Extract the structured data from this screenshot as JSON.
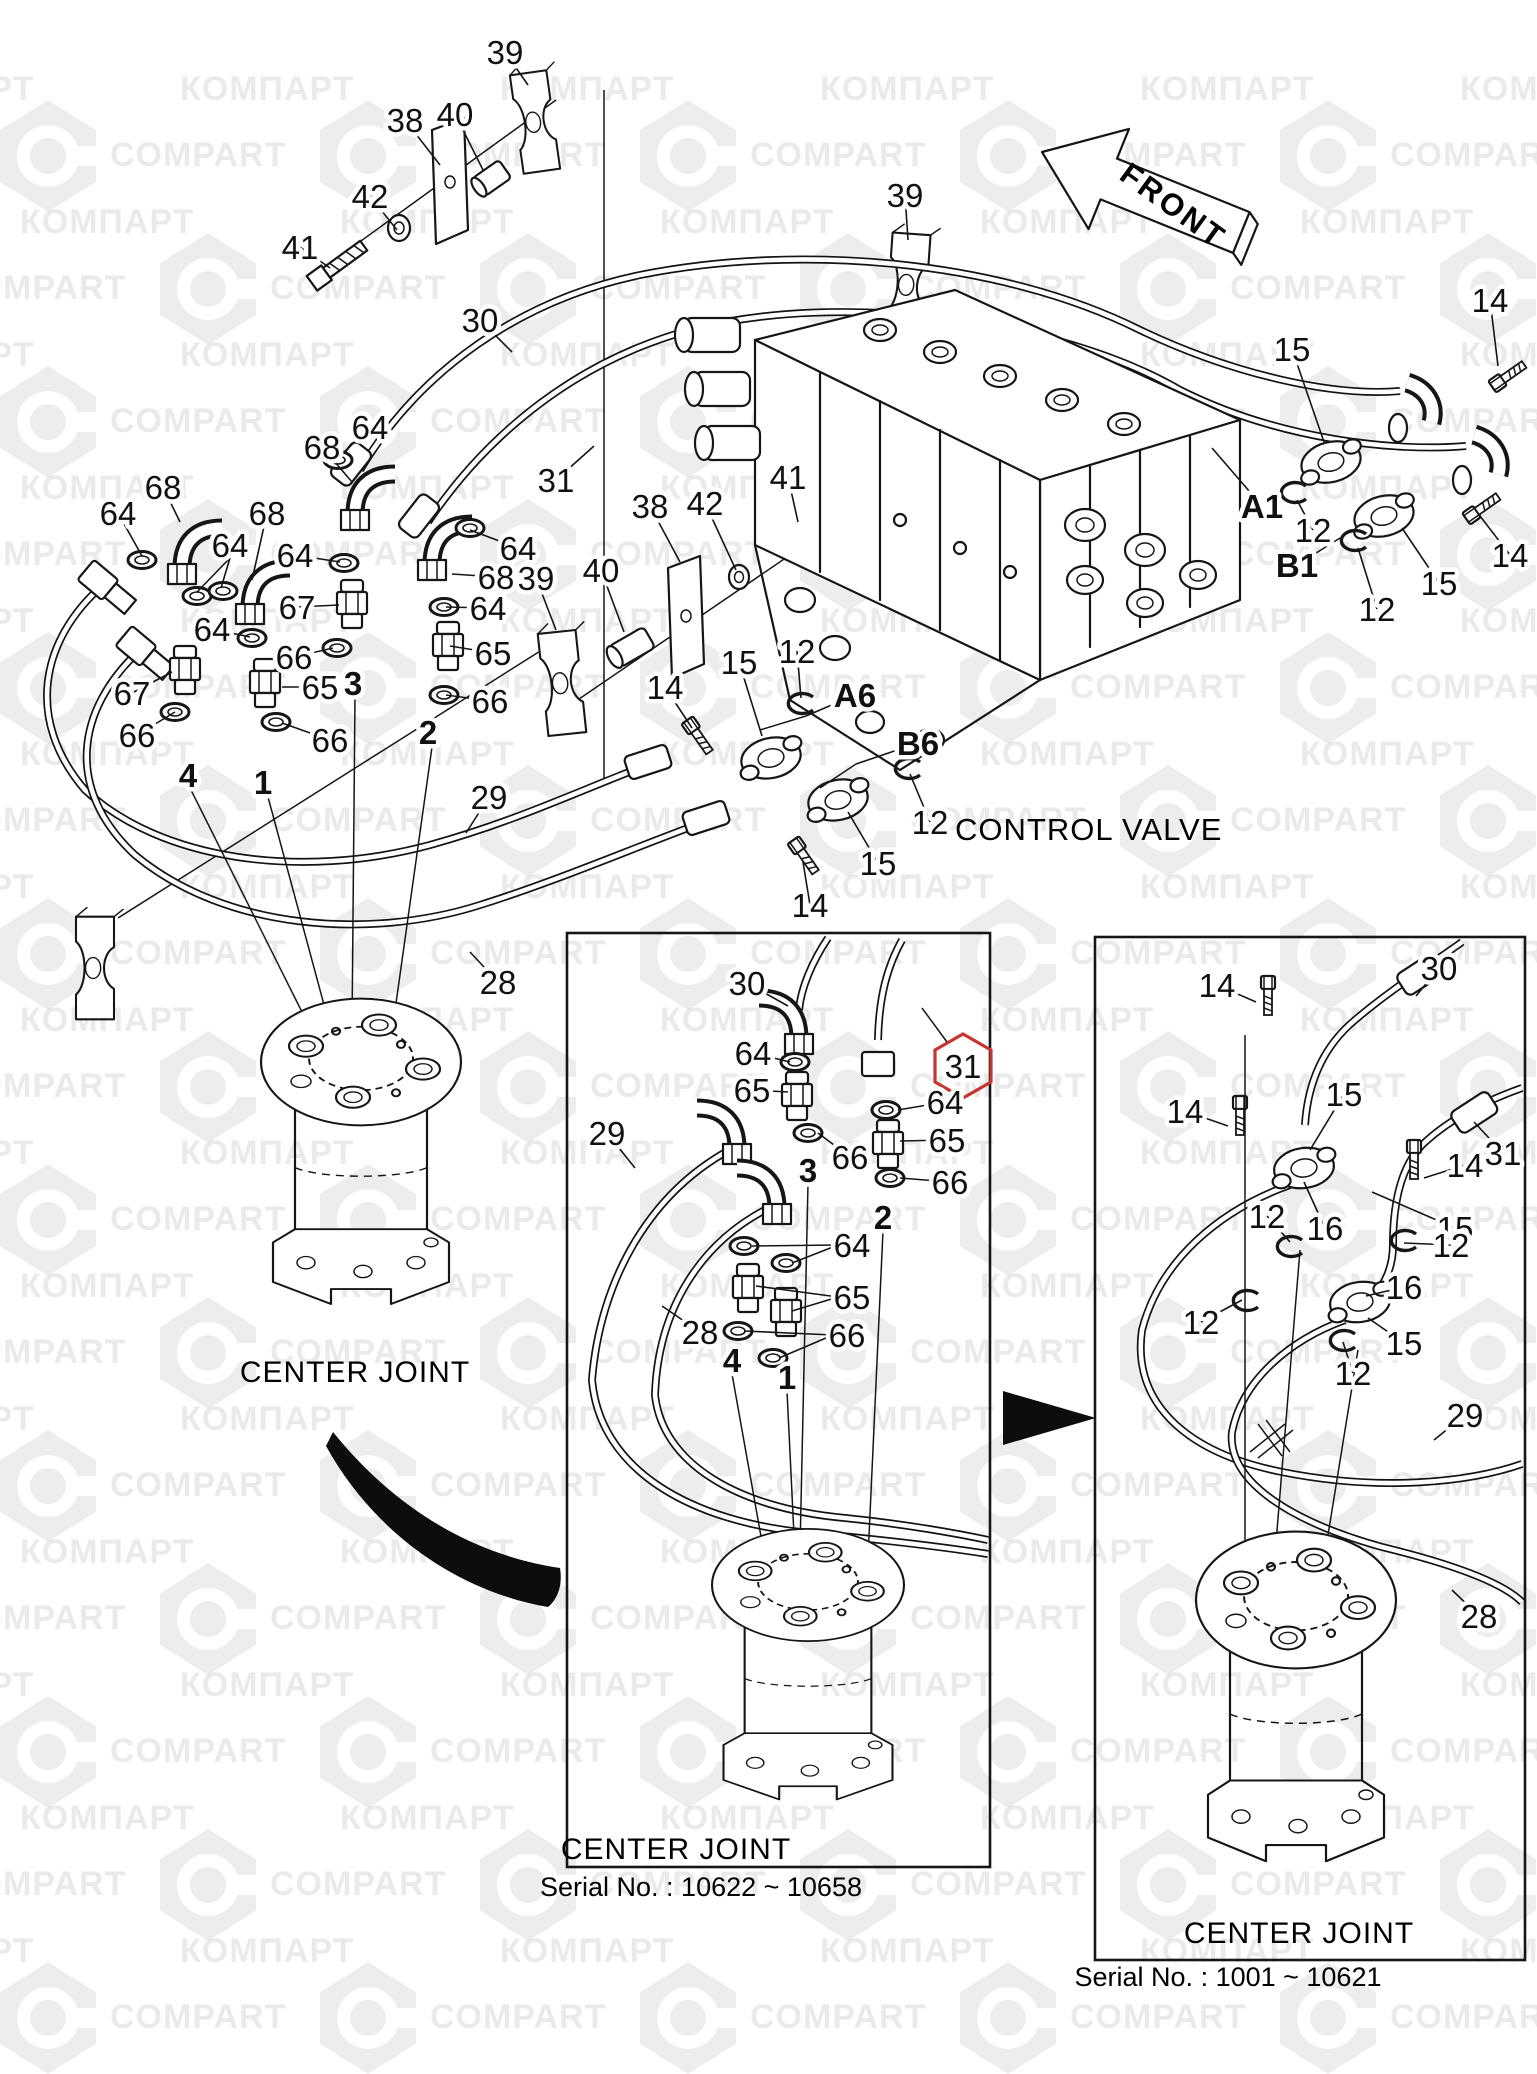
{
  "watermark": {
    "text_a": "КОМПАРТ",
    "text_b": "COMPART"
  },
  "front_label": "FRONT",
  "titles": {
    "control_valve": "CONTROL VALVE",
    "center_joint_main": "CENTER JOINT",
    "center_joint_mid": "CENTER JOINT",
    "center_joint_right": "CENTER JOINT",
    "serial_mid": "Serial No. : 10622 ~ 10658",
    "serial_right": "Serial No. : 1001 ~ 10621"
  },
  "highlight": {
    "part": "31",
    "color": "#c9342e"
  },
  "labels": [
    {
      "t": "41",
      "x": 300,
      "y": 247,
      "lx": 330,
      "ly": 268
    },
    {
      "t": "42",
      "x": 370,
      "y": 196,
      "lx": 397,
      "ly": 230
    },
    {
      "t": "38",
      "x": 405,
      "y": 120,
      "lx": 440,
      "ly": 165
    },
    {
      "t": "40",
      "x": 455,
      "y": 114,
      "lx": 483,
      "ly": 170
    },
    {
      "t": "39",
      "x": 505,
      "y": 52,
      "lx": 528,
      "ly": 85
    },
    {
      "t": "30",
      "x": 480,
      "y": 320,
      "lx": 512,
      "ly": 352
    },
    {
      "t": "31",
      "x": 556,
      "y": 480,
      "lx": 594,
      "ly": 446
    },
    {
      "t": "39",
      "x": 905,
      "y": 195,
      "lx": 908,
      "ly": 240
    },
    {
      "t": "64",
      "x": 370,
      "y": 427,
      "lx": 338,
      "ly": 458
    },
    {
      "t": "68",
      "x": 322,
      "y": 447,
      "lx": 352,
      "ly": 482
    },
    {
      "t": "68",
      "x": 163,
      "y": 487,
      "lx": 180,
      "ly": 522
    },
    {
      "t": "64",
      "x": 118,
      "y": 513,
      "lx": 142,
      "ly": 556
    },
    {
      "t": "68",
      "x": 267,
      "y": 513,
      "lx": 252,
      "ly": 580
    },
    {
      "t": "64",
      "x": 230,
      "y": 545,
      "leads": [
        [
          230,
          558,
          197,
          592
        ],
        [
          230,
          558,
          221,
          588
        ]
      ]
    },
    {
      "t": "64",
      "x": 295,
      "y": 555,
      "lx": 340,
      "ly": 562
    },
    {
      "t": "67",
      "x": 297,
      "y": 607,
      "lx": 339,
      "ly": 605
    },
    {
      "t": "64",
      "x": 212,
      "y": 629,
      "lx": 250,
      "ly": 637
    },
    {
      "t": "66",
      "x": 294,
      "y": 657,
      "lx": 333,
      "ly": 648
    },
    {
      "t": "65",
      "x": 320,
      "y": 687,
      "lx": 282,
      "ly": 687
    },
    {
      "t": "67",
      "x": 132,
      "y": 693,
      "lx": 172,
      "ly": 672
    },
    {
      "t": "66",
      "x": 137,
      "y": 735,
      "lx": 175,
      "ly": 712
    },
    {
      "t": "3",
      "x": 353,
      "y": 683,
      "b": 1
    },
    {
      "t": "4",
      "x": 188,
      "y": 775,
      "b": 1
    },
    {
      "t": "1",
      "x": 263,
      "y": 782,
      "b": 1
    },
    {
      "t": "2",
      "x": 428,
      "y": 732,
      "b": 1
    },
    {
      "t": "64",
      "x": 518,
      "y": 548,
      "lx": 470,
      "ly": 530
    },
    {
      "t": "68",
      "x": 496,
      "y": 577,
      "lx": 452,
      "ly": 574
    },
    {
      "t": "39",
      "x": 536,
      "y": 578,
      "lx": 556,
      "ly": 630
    },
    {
      "t": "64",
      "x": 488,
      "y": 608,
      "lx": 446,
      "ly": 607
    },
    {
      "t": "65",
      "x": 493,
      "y": 653,
      "lx": 450,
      "ly": 646
    },
    {
      "t": "66",
      "x": 490,
      "y": 701,
      "lx": 446,
      "ly": 695
    },
    {
      "t": "66",
      "x": 330,
      "y": 740,
      "lx": 282,
      "ly": 723
    },
    {
      "t": "40",
      "x": 601,
      "y": 570,
      "lx": 624,
      "ly": 632
    },
    {
      "t": "38",
      "x": 650,
      "y": 506,
      "lx": 680,
      "ly": 562
    },
    {
      "t": "42",
      "x": 705,
      "y": 503,
      "lx": 736,
      "ly": 570
    },
    {
      "t": "41",
      "x": 788,
      "y": 477,
      "lx": 798,
      "ly": 522
    },
    {
      "t": "14",
      "x": 665,
      "y": 687,
      "lx": 692,
      "ly": 728
    },
    {
      "t": "15",
      "x": 739,
      "y": 662,
      "lx": 762,
      "ly": 736
    },
    {
      "t": "12",
      "x": 797,
      "y": 651,
      "lx": 801,
      "ly": 698
    },
    {
      "t": "A6",
      "x": 855,
      "y": 695,
      "b": 1,
      "lx": 806,
      "ly": 716
    },
    {
      "t": "B6",
      "x": 918,
      "y": 743,
      "b": 1,
      "lx": 856,
      "ly": 764
    },
    {
      "t": "12",
      "x": 930,
      "y": 822,
      "lx": 910,
      "ly": 774
    },
    {
      "t": "15",
      "x": 878,
      "y": 863,
      "lx": 848,
      "ly": 812
    },
    {
      "t": "14",
      "x": 810,
      "y": 905,
      "lx": 803,
      "ly": 862
    },
    {
      "t": "29",
      "x": 489,
      "y": 797,
      "lx": 466,
      "ly": 833
    },
    {
      "t": "28",
      "x": 498,
      "y": 982,
      "lx": 470,
      "ly": 952
    },
    {
      "t": "15",
      "x": 1292,
      "y": 349,
      "lx": 1324,
      "ly": 442
    },
    {
      "t": "14",
      "x": 1490,
      "y": 300,
      "lx": 1498,
      "ly": 366
    },
    {
      "t": "A1",
      "x": 1262,
      "y": 506,
      "b": 1,
      "lx": 1212,
      "ly": 448
    },
    {
      "t": "12",
      "x": 1313,
      "y": 530,
      "lx": 1297,
      "ly": 500
    },
    {
      "t": "B1",
      "x": 1297,
      "y": 565,
      "b": 1,
      "lx": 1340,
      "ly": 538
    },
    {
      "t": "12",
      "x": 1377,
      "y": 609,
      "lx": 1358,
      "ly": 548
    },
    {
      "t": "15",
      "x": 1439,
      "y": 583,
      "lx": 1402,
      "ly": 528
    },
    {
      "t": "14",
      "x": 1510,
      "y": 555,
      "lx": 1480,
      "ly": 516
    },
    {
      "t": "30",
      "x": 747,
      "y": 983,
      "lx": 788,
      "ly": 1006
    },
    {
      "t": "64",
      "x": 753,
      "y": 1053,
      "lx": 790,
      "ly": 1062
    },
    {
      "t": "65",
      "x": 752,
      "y": 1090,
      "lx": 788,
      "ly": 1092
    },
    {
      "t": "66",
      "x": 850,
      "y": 1157,
      "lx": 818,
      "ly": 1133
    },
    {
      "t": "31",
      "x": 963,
      "y": 1066
    },
    {
      "t": "64",
      "x": 945,
      "y": 1102,
      "lx": 898,
      "ly": 1110
    },
    {
      "t": "65",
      "x": 947,
      "y": 1140,
      "lx": 900,
      "ly": 1141
    },
    {
      "t": "66",
      "x": 950,
      "y": 1182,
      "lx": 900,
      "ly": 1178
    },
    {
      "t": "29",
      "x": 607,
      "y": 1133,
      "lx": 635,
      "ly": 1168
    },
    {
      "t": "3",
      "x": 808,
      "y": 1170,
      "b": 1
    },
    {
      "t": "2",
      "x": 883,
      "y": 1217,
      "b": 1
    },
    {
      "t": "64",
      "x": 852,
      "y": 1245,
      "leads": [
        [
          838,
          1245,
          752,
          1246
        ],
        [
          838,
          1245,
          792,
          1263
        ]
      ]
    },
    {
      "t": "65",
      "x": 852,
      "y": 1297,
      "leads": [
        [
          838,
          1297,
          756,
          1286
        ],
        [
          838,
          1297,
          792,
          1311
        ]
      ]
    },
    {
      "t": "66",
      "x": 847,
      "y": 1335,
      "leads": [
        [
          833,
          1335,
          744,
          1331
        ],
        [
          833,
          1335,
          779,
          1358
        ]
      ]
    },
    {
      "t": "28",
      "x": 700,
      "y": 1332,
      "lx": 662,
      "ly": 1306
    },
    {
      "t": "4",
      "x": 732,
      "y": 1360,
      "b": 1
    },
    {
      "t": "1",
      "x": 787,
      "y": 1377,
      "b": 1
    },
    {
      "t": "14",
      "x": 1217,
      "y": 985,
      "lx": 1256,
      "ly": 1002
    },
    {
      "t": "30",
      "x": 1439,
      "y": 968,
      "lx": 1416,
      "ly": 996
    },
    {
      "t": "15",
      "x": 1344,
      "y": 1094,
      "lx": 1310,
      "ly": 1150
    },
    {
      "t": "14",
      "x": 1185,
      "y": 1111,
      "lx": 1228,
      "ly": 1126
    },
    {
      "t": "31",
      "x": 1503,
      "y": 1153,
      "lx": 1474,
      "ly": 1122
    },
    {
      "t": "14",
      "x": 1465,
      "y": 1165,
      "lx": 1424,
      "ly": 1178
    },
    {
      "t": "12",
      "x": 1267,
      "y": 1216,
      "lx": 1290,
      "ly": 1242
    },
    {
      "t": "16",
      "x": 1325,
      "y": 1228,
      "lx": 1304,
      "ly": 1182
    },
    {
      "t": "15",
      "x": 1455,
      "y": 1228,
      "lx": 1372,
      "ly": 1192
    },
    {
      "t": "12",
      "x": 1451,
      "y": 1245,
      "lx": 1404,
      "ly": 1243
    },
    {
      "t": "16",
      "x": 1404,
      "y": 1287,
      "lx": 1366,
      "ly": 1296
    },
    {
      "t": "15",
      "x": 1404,
      "y": 1343,
      "lx": 1368,
      "ly": 1318
    },
    {
      "t": "12",
      "x": 1201,
      "y": 1322,
      "lx": 1242,
      "ly": 1300
    },
    {
      "t": "12",
      "x": 1353,
      "y": 1373,
      "lx": 1343,
      "ly": 1342
    },
    {
      "t": "29",
      "x": 1465,
      "y": 1415,
      "lx": 1434,
      "ly": 1440
    },
    {
      "t": "28",
      "x": 1479,
      "y": 1616,
      "lx": 1452,
      "ly": 1590
    }
  ]
}
